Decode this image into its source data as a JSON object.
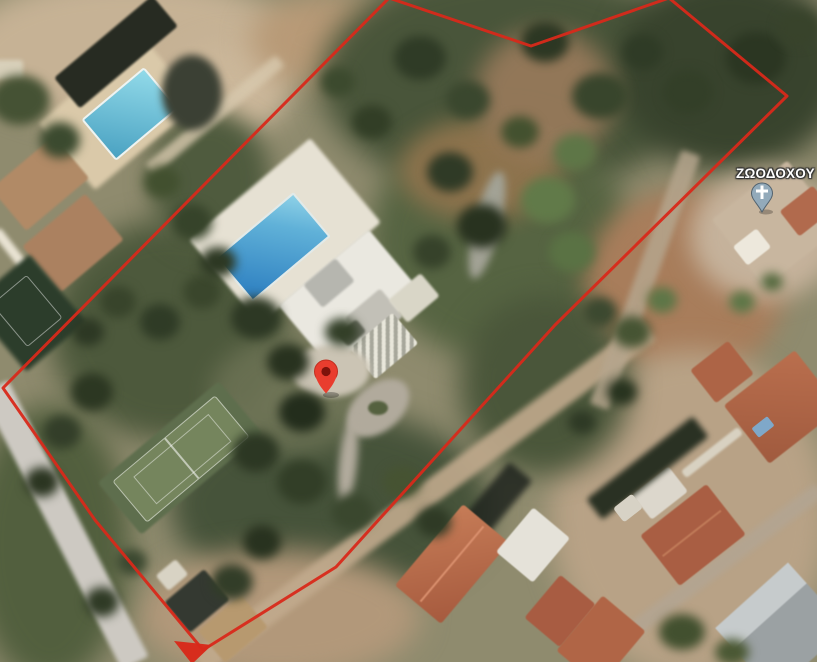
{
  "map": {
    "view": "satellite",
    "poi": {
      "label": "ΖΩΟΔΟΧΟΥ",
      "label_color": "#ffffff",
      "marker_fill": "#93aaba",
      "marker_stroke": "#52626e",
      "cross_color": "#ffffff"
    },
    "destination_pin": {
      "fill": "#e93d2e",
      "stroke": "#c12f20",
      "dot": "#7e130b"
    },
    "boundary": {
      "stroke": "#d8291a",
      "points": "389,-2 531,46 669,-2 787,96 555,325 336,567 203,650 95,520 3,388",
      "arrow_points": "174,641 212,645 192,664"
    }
  }
}
